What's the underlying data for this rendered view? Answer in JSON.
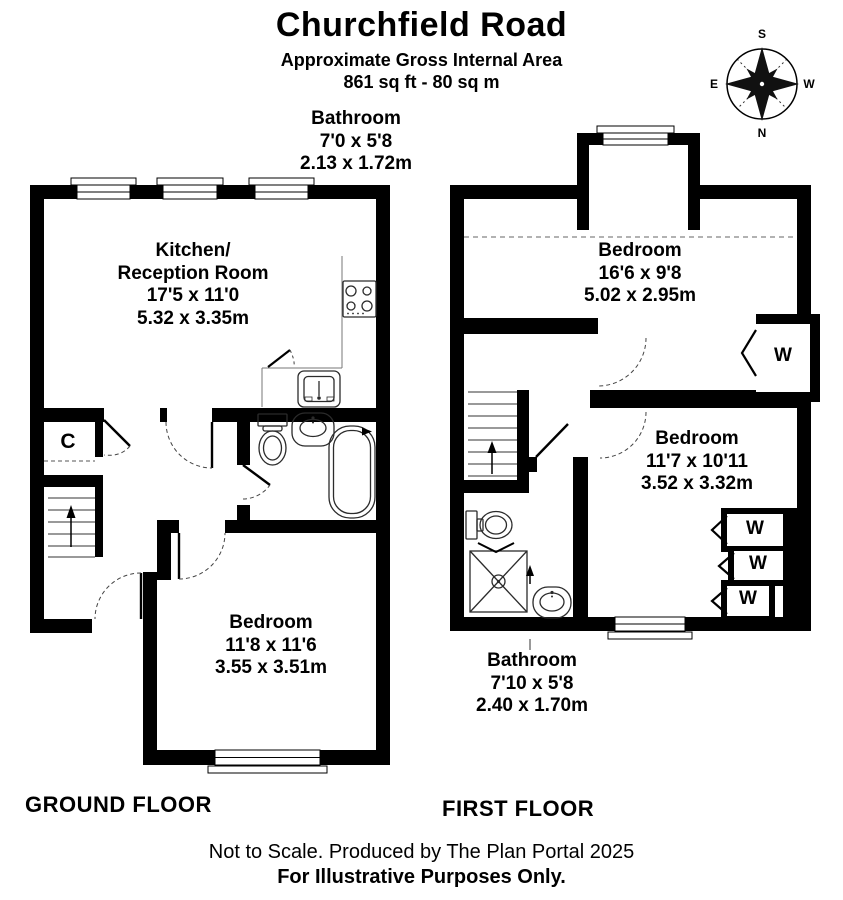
{
  "header": {
    "title": "Churchfield Road",
    "subtitle_line1": "Approximate Gross Internal Area",
    "subtitle_line2": "861 sq ft - 80 sq m"
  },
  "compass": {
    "top": "S",
    "right": "W",
    "bottom": "N",
    "left": "E"
  },
  "ground_floor": {
    "floor_label": "GROUND FLOOR",
    "bathroom_label": {
      "name": "Bathroom",
      "imperial": "7'0 x 5'8",
      "metric": "2.13 x 1.72m"
    },
    "kitchen_label": {
      "name_line1": "Kitchen/",
      "name_line2": "Reception Room",
      "imperial": "17'5 x 11'0",
      "metric": "5.32 x 3.35m"
    },
    "bedroom_label": {
      "name": "Bedroom",
      "imperial": "11'8 x 11'6",
      "metric": "3.55 x 3.51m"
    },
    "closet_label": "C"
  },
  "first_floor": {
    "floor_label": "FIRST FLOOR",
    "bedroom1_label": {
      "name": "Bedroom",
      "imperial": "16'6 x 9'8",
      "metric": "5.02 x 2.95m"
    },
    "bedroom2_label": {
      "name": "Bedroom",
      "imperial": "11'7 x 10'11",
      "metric": "3.52 x 3.32m"
    },
    "bathroom_label": {
      "name": "Bathroom",
      "imperial": "7'10 x 5'8",
      "metric": "2.40 x 1.70m"
    },
    "wardrobe_label": "W"
  },
  "footer": {
    "line1": "Not to Scale. Produced by The Plan Portal 2025",
    "line2": "For Illustrative Purposes Only."
  },
  "colors": {
    "walls": "#000000",
    "background": "#ffffff",
    "fixture_line": "#2b2b2b"
  }
}
